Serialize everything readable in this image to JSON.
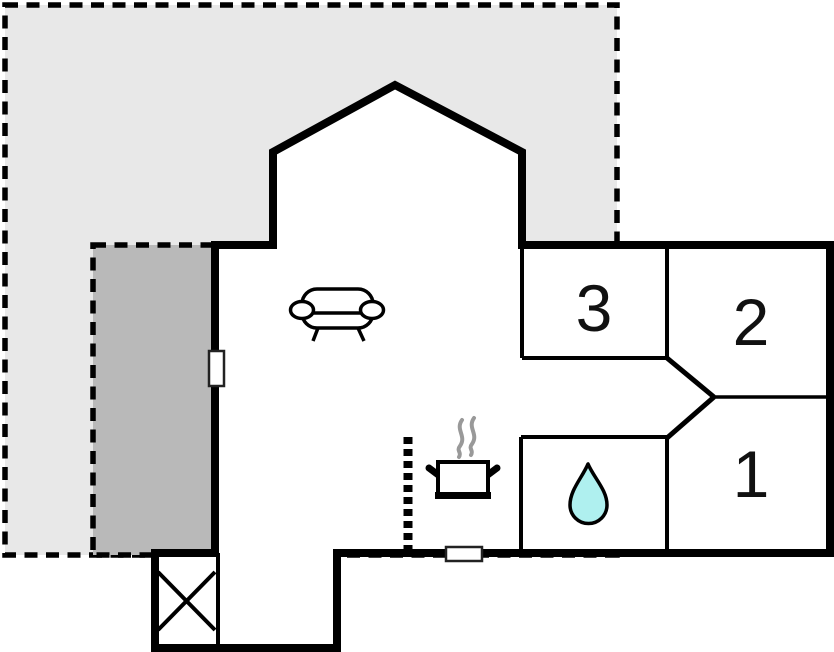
{
  "floorplan": {
    "rooms": {
      "bedroom3": {
        "label": "3"
      },
      "bedroom2": {
        "label": "2"
      },
      "bedroom1": {
        "label": "1"
      }
    },
    "icons": {
      "sofa": "sofa-icon",
      "stove": "cooking-pot-icon",
      "water": "water-drop-icon",
      "cross_box": "crossed-box-icon"
    },
    "colors": {
      "terrace_light": "#e8e8e8",
      "terrace_dark": "#b9b9b9",
      "wall": "#000000",
      "water_drop": "#aff0ef",
      "steam": "#999999"
    }
  }
}
